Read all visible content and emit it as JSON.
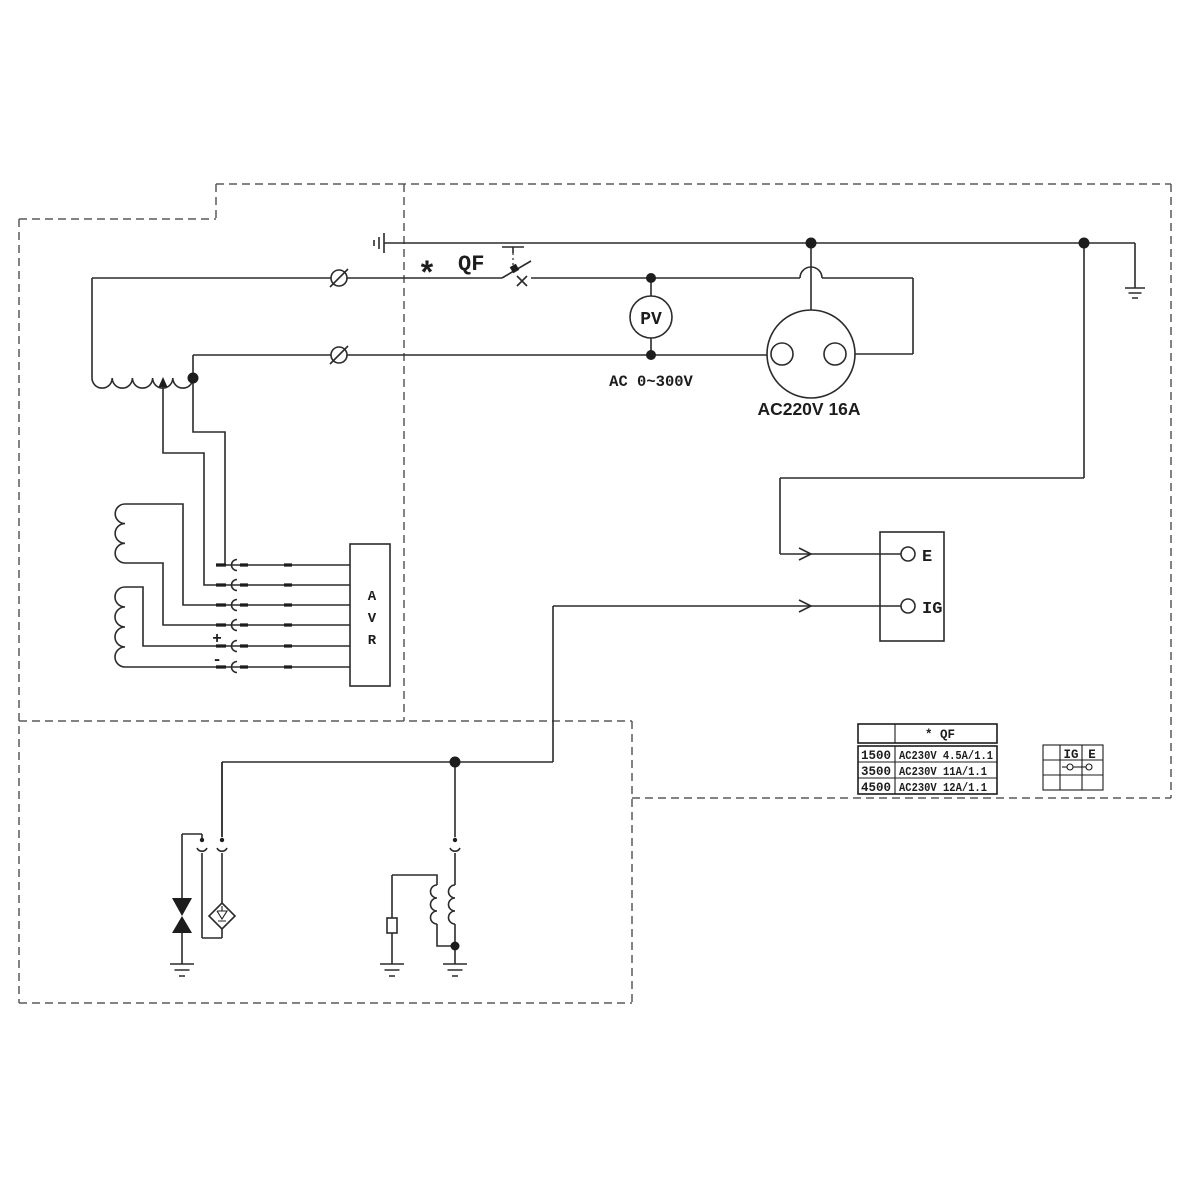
{
  "colors": {
    "line": "#2b2b2b",
    "dashed_border": "#5a5a5a",
    "background": "#ffffff"
  },
  "generator": {
    "star": "*",
    "qf": "QF",
    "avr_letters": [
      "A",
      "V",
      "R"
    ],
    "plus": "+",
    "minus": "-"
  },
  "output": {
    "voltmeter": "PV",
    "voltmeter_range": "AC 0~300V",
    "socket_label": "AC220V 16A"
  },
  "control": {
    "terminal_e": "E",
    "terminal_ig": "IG"
  },
  "qf_table": {
    "header": "* QF",
    "rows": [
      {
        "model": "1500",
        "spec": "AC230V 4.5A/1.1"
      },
      {
        "model": "3500",
        "spec": "AC230V 11A/1.1"
      },
      {
        "model": "4500",
        "spec": "AC230V 12A/1.1"
      }
    ]
  },
  "switch_table": {
    "col_ig": "IG",
    "col_e": "E"
  }
}
